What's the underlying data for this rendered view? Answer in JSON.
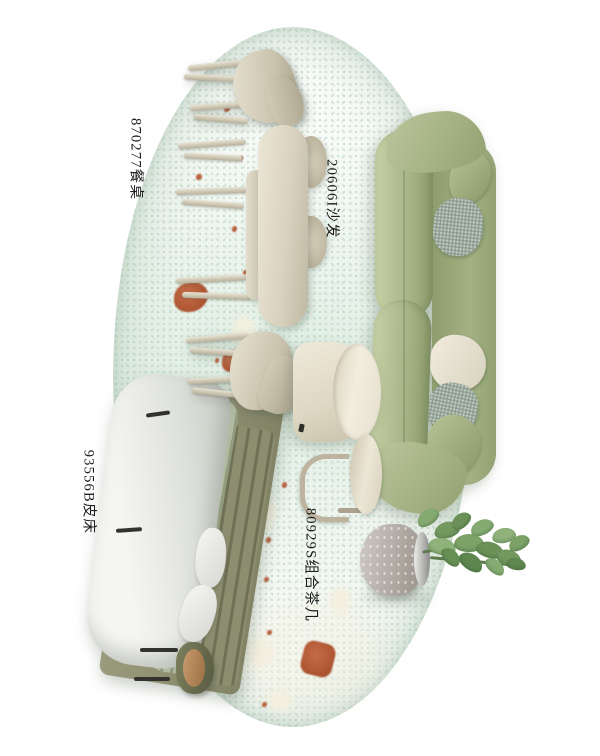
{
  "image": {
    "kind": "furniture product collage, rotated top view on oval rug",
    "background": "#ffffff"
  },
  "labels": {
    "dining_table": "870277餐桌",
    "sofa": "20606I沙发",
    "bed": "93556B皮床",
    "coffee_table": "80929S组合茶几"
  },
  "colors": {
    "background": "#ffffff",
    "rug_base": "#edf3ec",
    "rug_speckle": "#bcd6c5",
    "rust_accent": "#b5532f",
    "cream_furniture": "#ddd6c2",
    "sofa_green": "#a9b689",
    "pillow_gray_green": "#8e9d91",
    "pillow_cream": "#efeadb",
    "bed_olive": "#8d8e6f",
    "duvet_white": "#f2f3f0",
    "stool_wood": "#b98d62",
    "plant_green": "#7ca268",
    "pot_gray": "#b3aba3",
    "label_text": "#1c1c1c"
  }
}
